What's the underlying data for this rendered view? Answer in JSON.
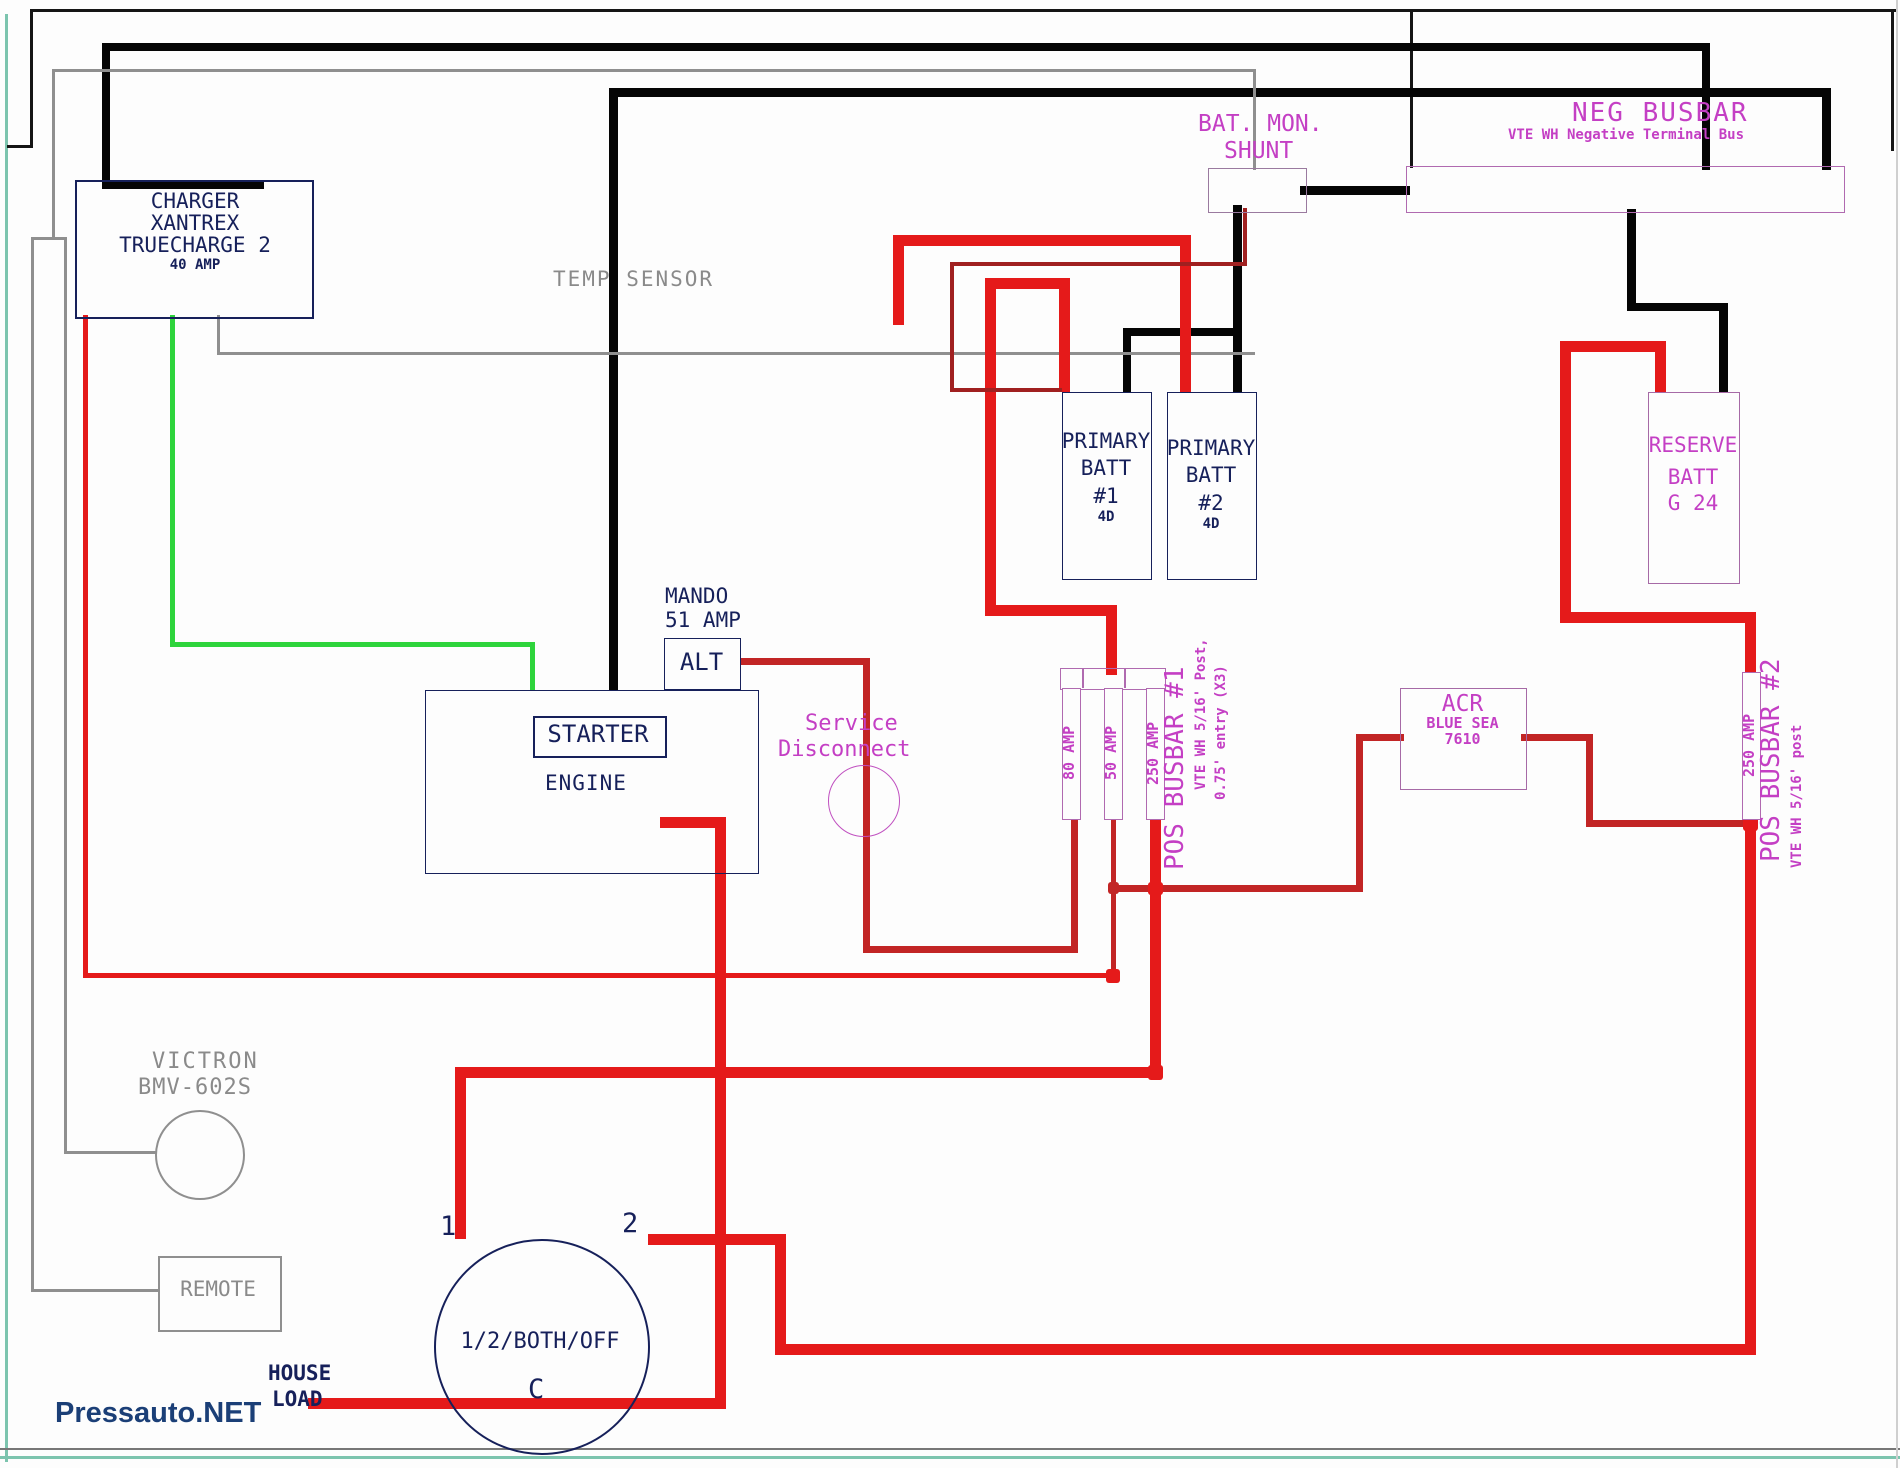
{
  "diagram": {
    "watermark": "Pressauto.NET",
    "charger": {
      "line1": "CHARGER",
      "line2": "XANTREX",
      "line3": "TRUECHARGE 2",
      "line4": "40 AMP"
    },
    "temp_sensor": "TEMP SENSOR",
    "shunt": {
      "title1": "BAT. MON.",
      "title2": "SHUNT"
    },
    "neg_busbar": {
      "title": "NEG BUSBAR",
      "subtitle": "VTE WH Negative Terminal Bus"
    },
    "primary_batt1": {
      "l1": "PRIMARY",
      "l2": "BATT",
      "l3": "#1",
      "l4": "4D"
    },
    "primary_batt2": {
      "l1": "PRIMARY",
      "l2": "BATT",
      "l3": "#2",
      "l4": "4D"
    },
    "reserve_batt": {
      "l1": "RESERVE",
      "l2": "BATT",
      "l3": "G 24"
    },
    "alternator": {
      "l1": "MANDO",
      "l2": "51 AMP",
      "label": "ALT"
    },
    "engine": {
      "starter": "STARTER",
      "engine": "ENGINE"
    },
    "service_disconnect": {
      "l1": "Service",
      "l2": "Disconnect"
    },
    "fuse_80": "80 AMP",
    "fuse_50": "50 AMP",
    "fuse_250": "250 AMP",
    "pos_busbar1": {
      "title": "POS BUSBAR #1",
      "sub1": "VTE WH 5/16' Post,",
      "sub2": "0.75' entry (X3)"
    },
    "fuse_250_2": "250 AMP",
    "pos_busbar2": {
      "title": "POS BUSBAR #2",
      "sub1": "VTE WH 5/16' post"
    },
    "acr": {
      "l1": "ACR",
      "l2": "BLUE SEA",
      "l3": "7610"
    },
    "victron": {
      "l1": "VICTRON",
      "l2": "BMV-602S"
    },
    "remote": "REMOTE",
    "switch": {
      "label": "1/2/BOTH/OFF",
      "t1": "1",
      "t2": "2",
      "tc": "C"
    },
    "house_load": {
      "l1": "HOUSE",
      "l2": "LOAD"
    }
  },
  "colors": {
    "navy": "#16205a",
    "magenta": "#c43fc4",
    "purple_line": "#b06ab0",
    "red": "#e51a1a",
    "red_mid": "#c22525",
    "red_dark": "#a02020",
    "green": "#2ed43c",
    "teal": "#7cc4ae"
  }
}
